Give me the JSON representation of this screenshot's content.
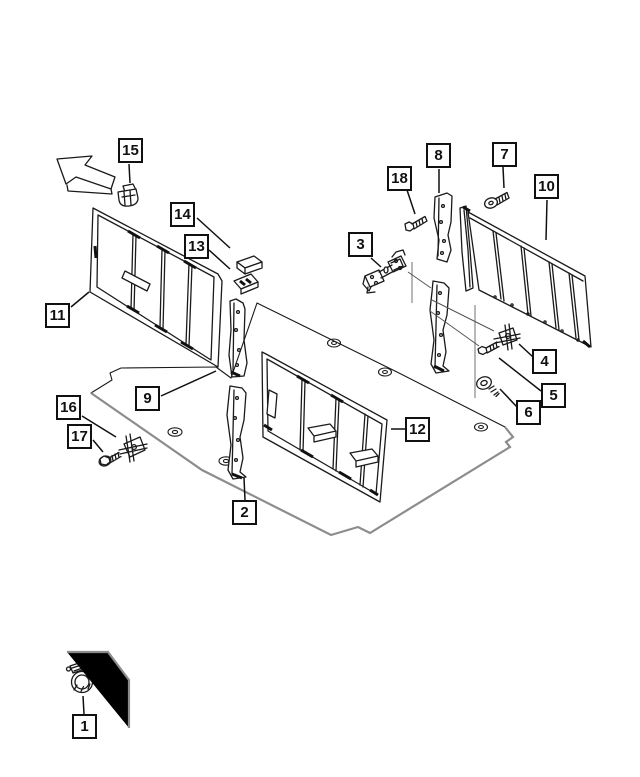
{
  "colors": {
    "line": "#1a1a1a",
    "gray_line": "#8c8c8c",
    "callout_border": "#111111",
    "background": "#ffffff"
  },
  "direction_arrow_icon": "arrow-up-left-icon",
  "callouts": [
    {
      "label": "1",
      "part_icon": "hose-clamp-icon"
    },
    {
      "label": "2",
      "part_icon": "pillar-bracket-icon"
    },
    {
      "label": "3",
      "part_icon": "check-hinge-icon"
    },
    {
      "label": "4",
      "part_icon": "retainer-clip-icon"
    },
    {
      "label": "5",
      "part_icon": "screw-icon"
    },
    {
      "label": "6",
      "part_icon": "push-pin-icon"
    },
    {
      "label": "7",
      "part_icon": "flat-head-screw-icon"
    },
    {
      "label": "8",
      "part_icon": "pillar-bracket-icon"
    },
    {
      "label": "9",
      "part_icon": "pillar-bracket-icon"
    },
    {
      "label": "10",
      "part_icon": "slatted-panel-icon"
    },
    {
      "label": "11",
      "part_icon": "slatted-panel-icon"
    },
    {
      "label": "12",
      "part_icon": "slatted-panel-icon"
    },
    {
      "label": "13",
      "part_icon": "spacer-clip-icon"
    },
    {
      "label": "14",
      "part_icon": "spacer-block-icon"
    },
    {
      "label": "15",
      "part_icon": "retainer-clip-icon"
    },
    {
      "label": "16",
      "part_icon": "retainer-clip-icon"
    },
    {
      "label": "17",
      "part_icon": "screw-icon"
    },
    {
      "label": "18",
      "part_icon": "hex-bolt-icon"
    }
  ]
}
